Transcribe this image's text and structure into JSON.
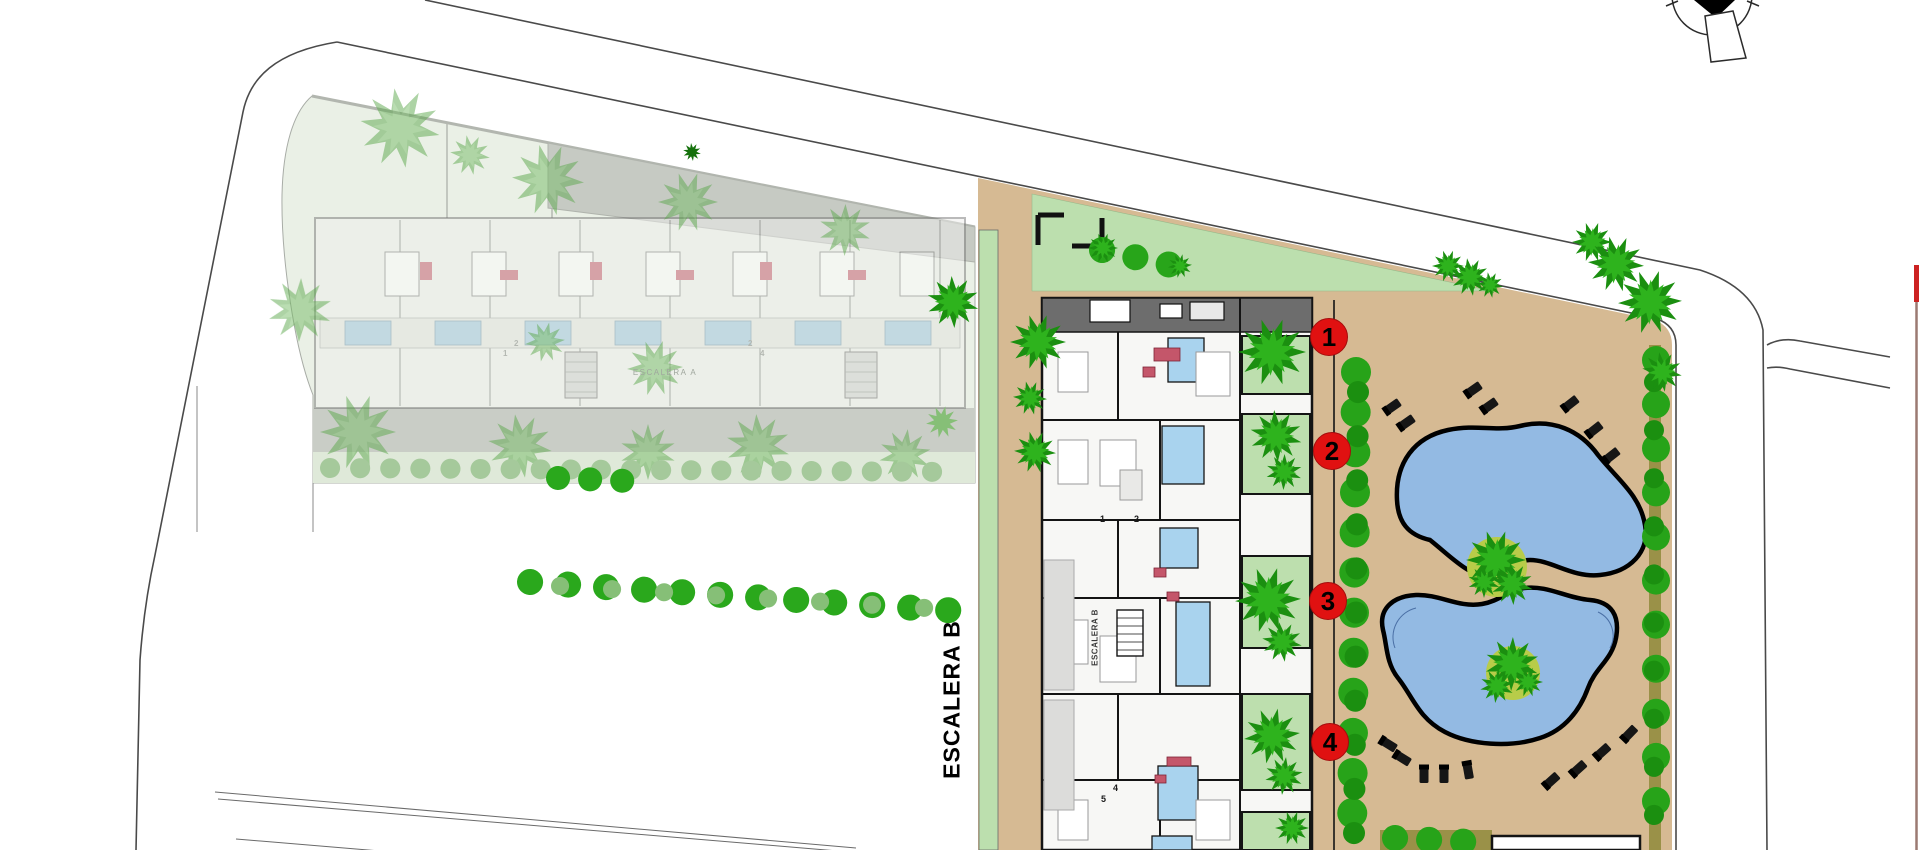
{
  "plan": {
    "street_stair_label": "ESCALERA B",
    "building_b_core_label": "ESCALERA B",
    "building_a_core_label": "ESCALERA A",
    "unit_markers": [
      {
        "number": "1"
      },
      {
        "number": "2"
      },
      {
        "number": "3"
      },
      {
        "number": "4"
      }
    ],
    "building_b_plan_numbers": [
      "1",
      "2",
      "4",
      "5"
    ],
    "building_a_plan_numbers": [
      "1",
      "2",
      "2",
      "4"
    ],
    "compass_icon": "north-arrow",
    "colors": {
      "road_line": "#4a4a4a",
      "faded_zone_bg": "#eaf0e6",
      "faded_block_gray": "#c6cac3",
      "faded_path_gray": "#c9cdc6",
      "lawn_green": "#bcdfae",
      "deck_tan": "#d6ba93",
      "tree_dark_green": "#1b8f10",
      "tree_mid_green": "#2eb31d",
      "pool_blue": "#93bae3",
      "pool_outline": "#000000",
      "island_yellow_green": "#b8cc49",
      "olive_path": "#9a9148",
      "marker_red": "#e01111",
      "building_wall": "#141414",
      "roof_gray": "#6d6d6d",
      "bath_blue": "#a9d3ee",
      "sofa_red": "#c4566a",
      "plot_edge_brown": "#9b7a72",
      "plot_edge_red": "#cc2222"
    }
  }
}
